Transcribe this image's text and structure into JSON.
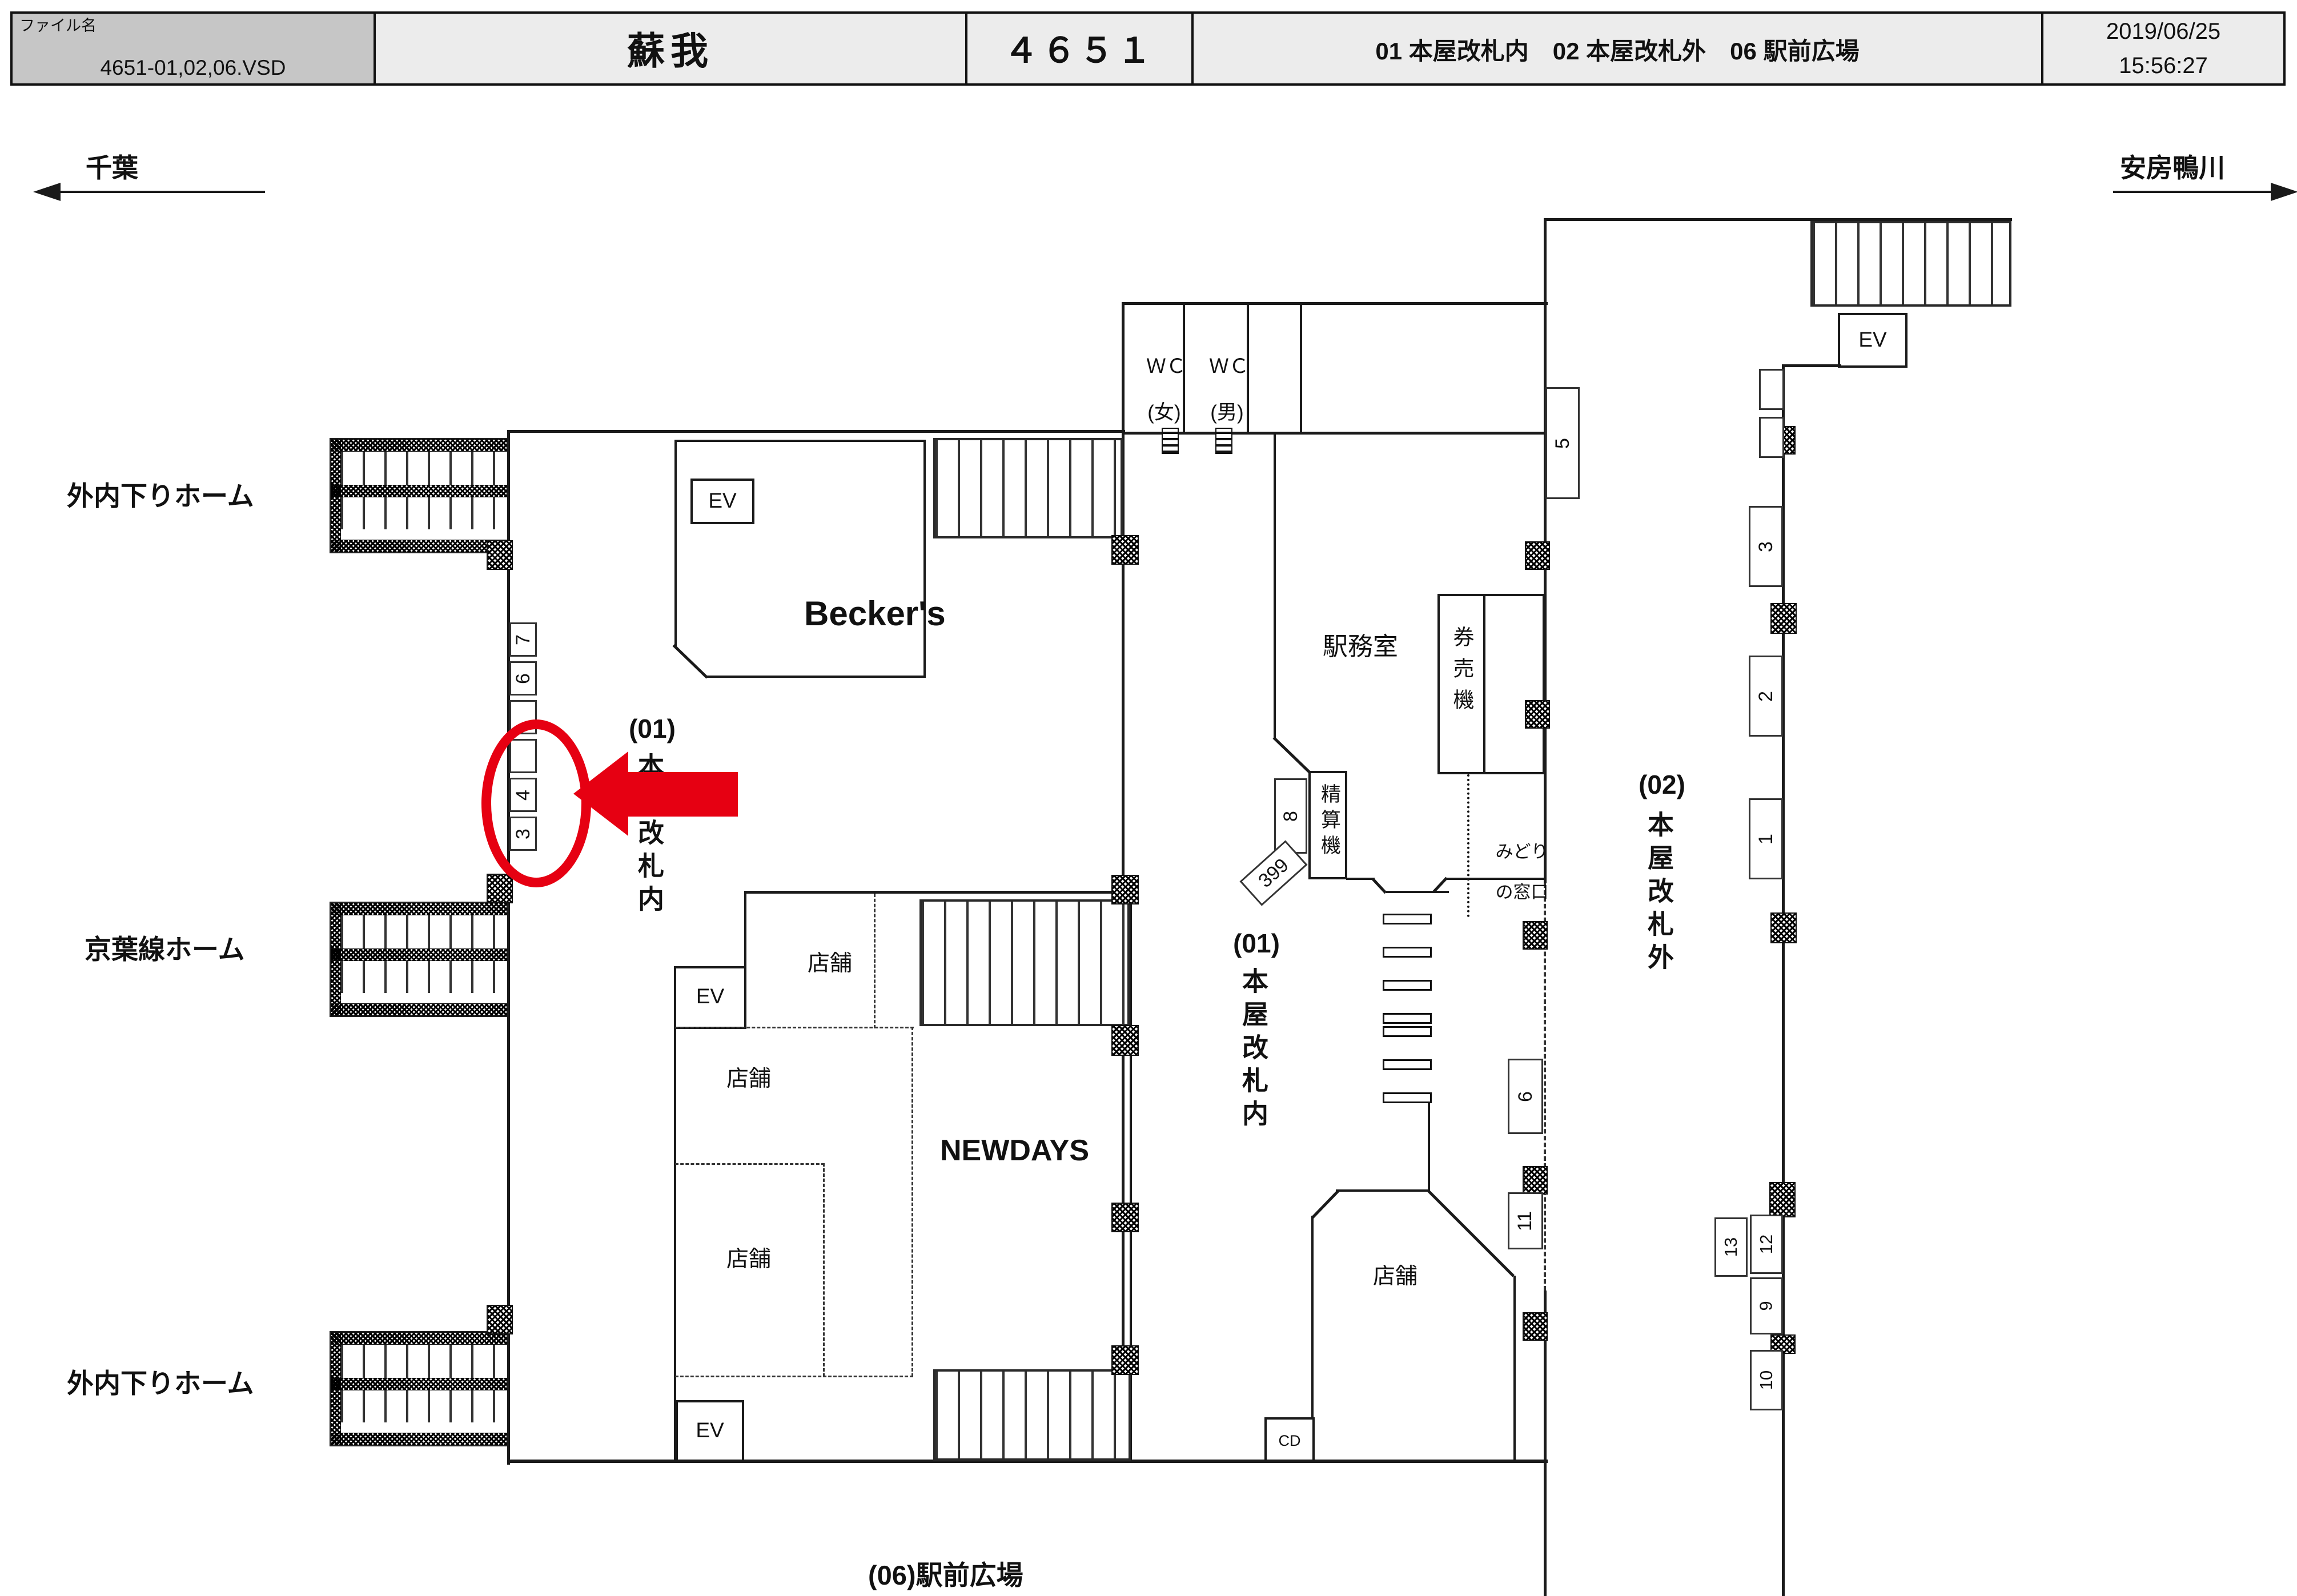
{
  "colors": {
    "highlight": "#e60012",
    "line": "#1a1a1a",
    "file_cell_gray": "#c6c6c6",
    "header_cell_gray": "#ececec"
  },
  "header": {
    "file_label": "ファイル名",
    "file_name": "4651-01,02,06.VSD",
    "station": "蘇我",
    "sheet_number": "４６５１",
    "locations": "01 本屋改札内　02 本屋改札外　06 駅前広場",
    "date": "2019/06/25",
    "time": "15:56:27"
  },
  "directions": {
    "left": "千葉",
    "right": "安房鴨川"
  },
  "platforms": {
    "top": "外内下りホーム",
    "middle": "京葉線ホーム",
    "bottom": "外内下りホーム"
  },
  "areas": {
    "area01_no": "(01)",
    "area01": "本屋改札内",
    "area02_no": "(02)",
    "area02": "本屋改札外",
    "plaza": "(06)駅前広場"
  },
  "rooms": {
    "beckers": "Becker's",
    "newdays": "NEWDAYS",
    "shop": "店舗",
    "office": "駅務室",
    "ticket_machine": "券売機",
    "midori1": "みどり",
    "midori2": "の窓口",
    "fare_adjustment": "精算機",
    "wc": "ＷＣ",
    "wc_women": "(女)",
    "wc_men": "(男)",
    "ev": "EV",
    "cd": "CD"
  },
  "positions": {
    "left": [
      "7",
      "6",
      "",
      "",
      "4",
      "3"
    ],
    "mid5": "5",
    "mid8": "8",
    "mid399": "399",
    "mid6": "6",
    "mid11": "11",
    "right": [
      "3",
      "2",
      "1"
    ],
    "rb12": "12",
    "rb13": "13",
    "rb9": "9",
    "rb10": "10"
  }
}
